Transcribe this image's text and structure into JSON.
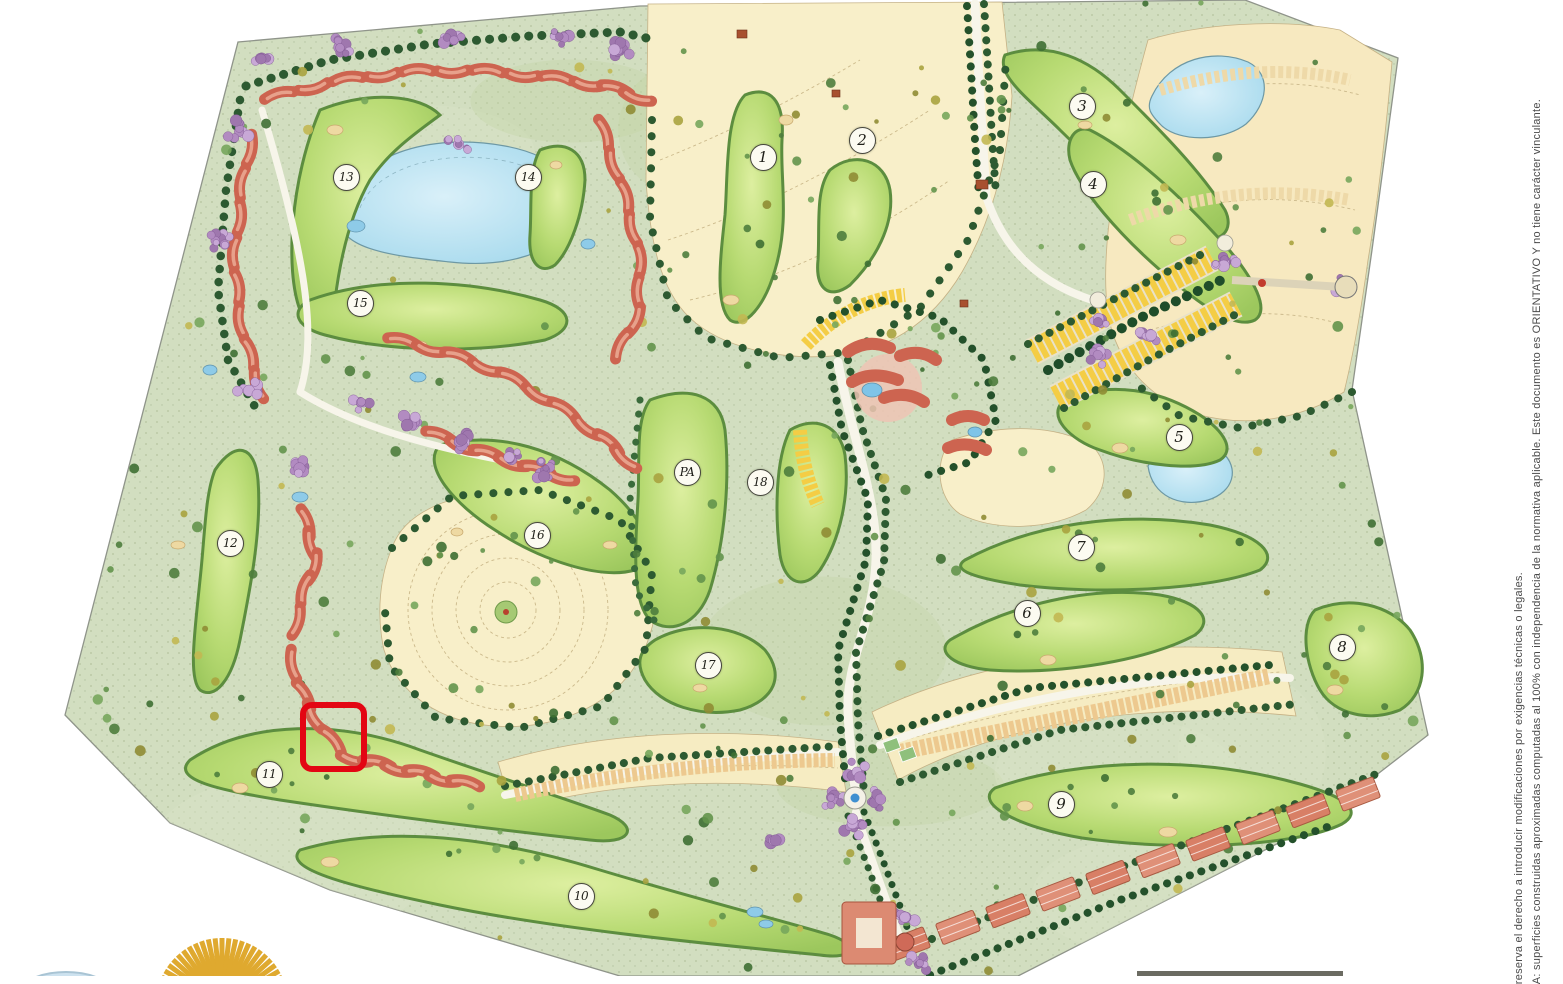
{
  "map": {
    "type": "golf-resort-masterplan",
    "hole_markers": [
      {
        "label": "1",
        "x": 763,
        "y": 157
      },
      {
        "label": "2",
        "x": 862,
        "y": 140
      },
      {
        "label": "3",
        "x": 1082,
        "y": 106
      },
      {
        "label": "4",
        "x": 1093,
        "y": 184
      },
      {
        "label": "5",
        "x": 1179,
        "y": 437
      },
      {
        "label": "6",
        "x": 1027,
        "y": 613
      },
      {
        "label": "7",
        "x": 1081,
        "y": 547
      },
      {
        "label": "8",
        "x": 1342,
        "y": 647
      },
      {
        "label": "9",
        "x": 1061,
        "y": 804
      },
      {
        "label": "10",
        "x": 581,
        "y": 896
      },
      {
        "label": "11",
        "x": 269,
        "y": 774
      },
      {
        "label": "12",
        "x": 230,
        "y": 543
      },
      {
        "label": "13",
        "x": 346,
        "y": 177
      },
      {
        "label": "14",
        "x": 528,
        "y": 177
      },
      {
        "label": "15",
        "x": 360,
        "y": 303
      },
      {
        "label": "16",
        "x": 537,
        "y": 535
      },
      {
        "label": "17",
        "x": 708,
        "y": 665
      },
      {
        "label": "18",
        "x": 760,
        "y": 482
      },
      {
        "label": "PA",
        "x": 687,
        "y": 472
      }
    ],
    "highlight": {
      "x": 300,
      "y": 702,
      "width": 67,
      "height": 70,
      "color": "#e30613"
    }
  },
  "disclaimer": {
    "line1": "A: superficies construidas aproximadas computadas al 100% con independencia de la normativa aplicable.  Este documento es ORIENTATIVO Y  no tiene carácter vinculante.",
    "line2": "reserva el derecho a introducir modificaciones por exigencias  técnicas o legales."
  },
  "colors": {
    "highlight_red": "#e30613",
    "site_green": "#d2dec0",
    "fairway_green": "#b7da72",
    "water_blue": "#aadcee",
    "plot_cream": "#f8efc9",
    "townhouse_yellow": "#f4cd45",
    "building_red": "#cd6450",
    "tree_dark_green": "#2e5c33",
    "flowering_purple": "#b28bc1",
    "sun_gold": "#dfa92f"
  }
}
